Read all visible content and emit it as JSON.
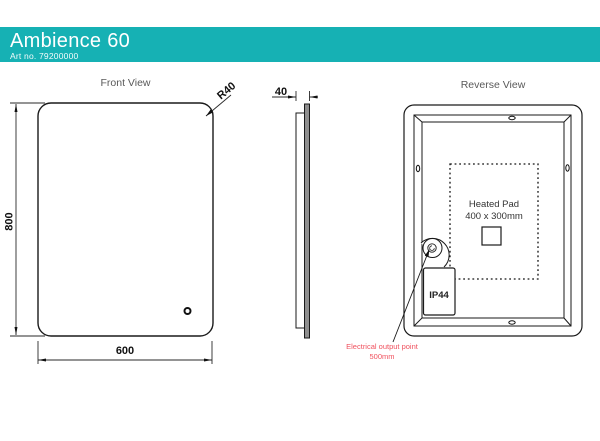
{
  "header": {
    "title": "Ambience 60",
    "art_no": "Art no. 79200000",
    "bg_color": "#16b1b4",
    "text_color": "#ffffff"
  },
  "front_view": {
    "title": "Front View",
    "dims": {
      "height_mm": "800",
      "width_mm": "600",
      "corner_radius": "R40"
    }
  },
  "side_view": {
    "dims": {
      "depth_mm": "40"
    }
  },
  "reverse_view": {
    "title": "Reverse View",
    "heated_pad_line1": "Heated Pad",
    "heated_pad_line2": "400 x 300mm",
    "ip_rating": "IP44",
    "electrical_note_line1": "Electrical output point",
    "electrical_note_line2": "500mm",
    "note_color": "#f0515e"
  },
  "colors": {
    "accent_teal": "#16b1b4",
    "line_black": "#1a1a1a",
    "note_red": "#f0515e",
    "title_gray": "#595959",
    "glass_gray": "#8f8f8f"
  }
}
